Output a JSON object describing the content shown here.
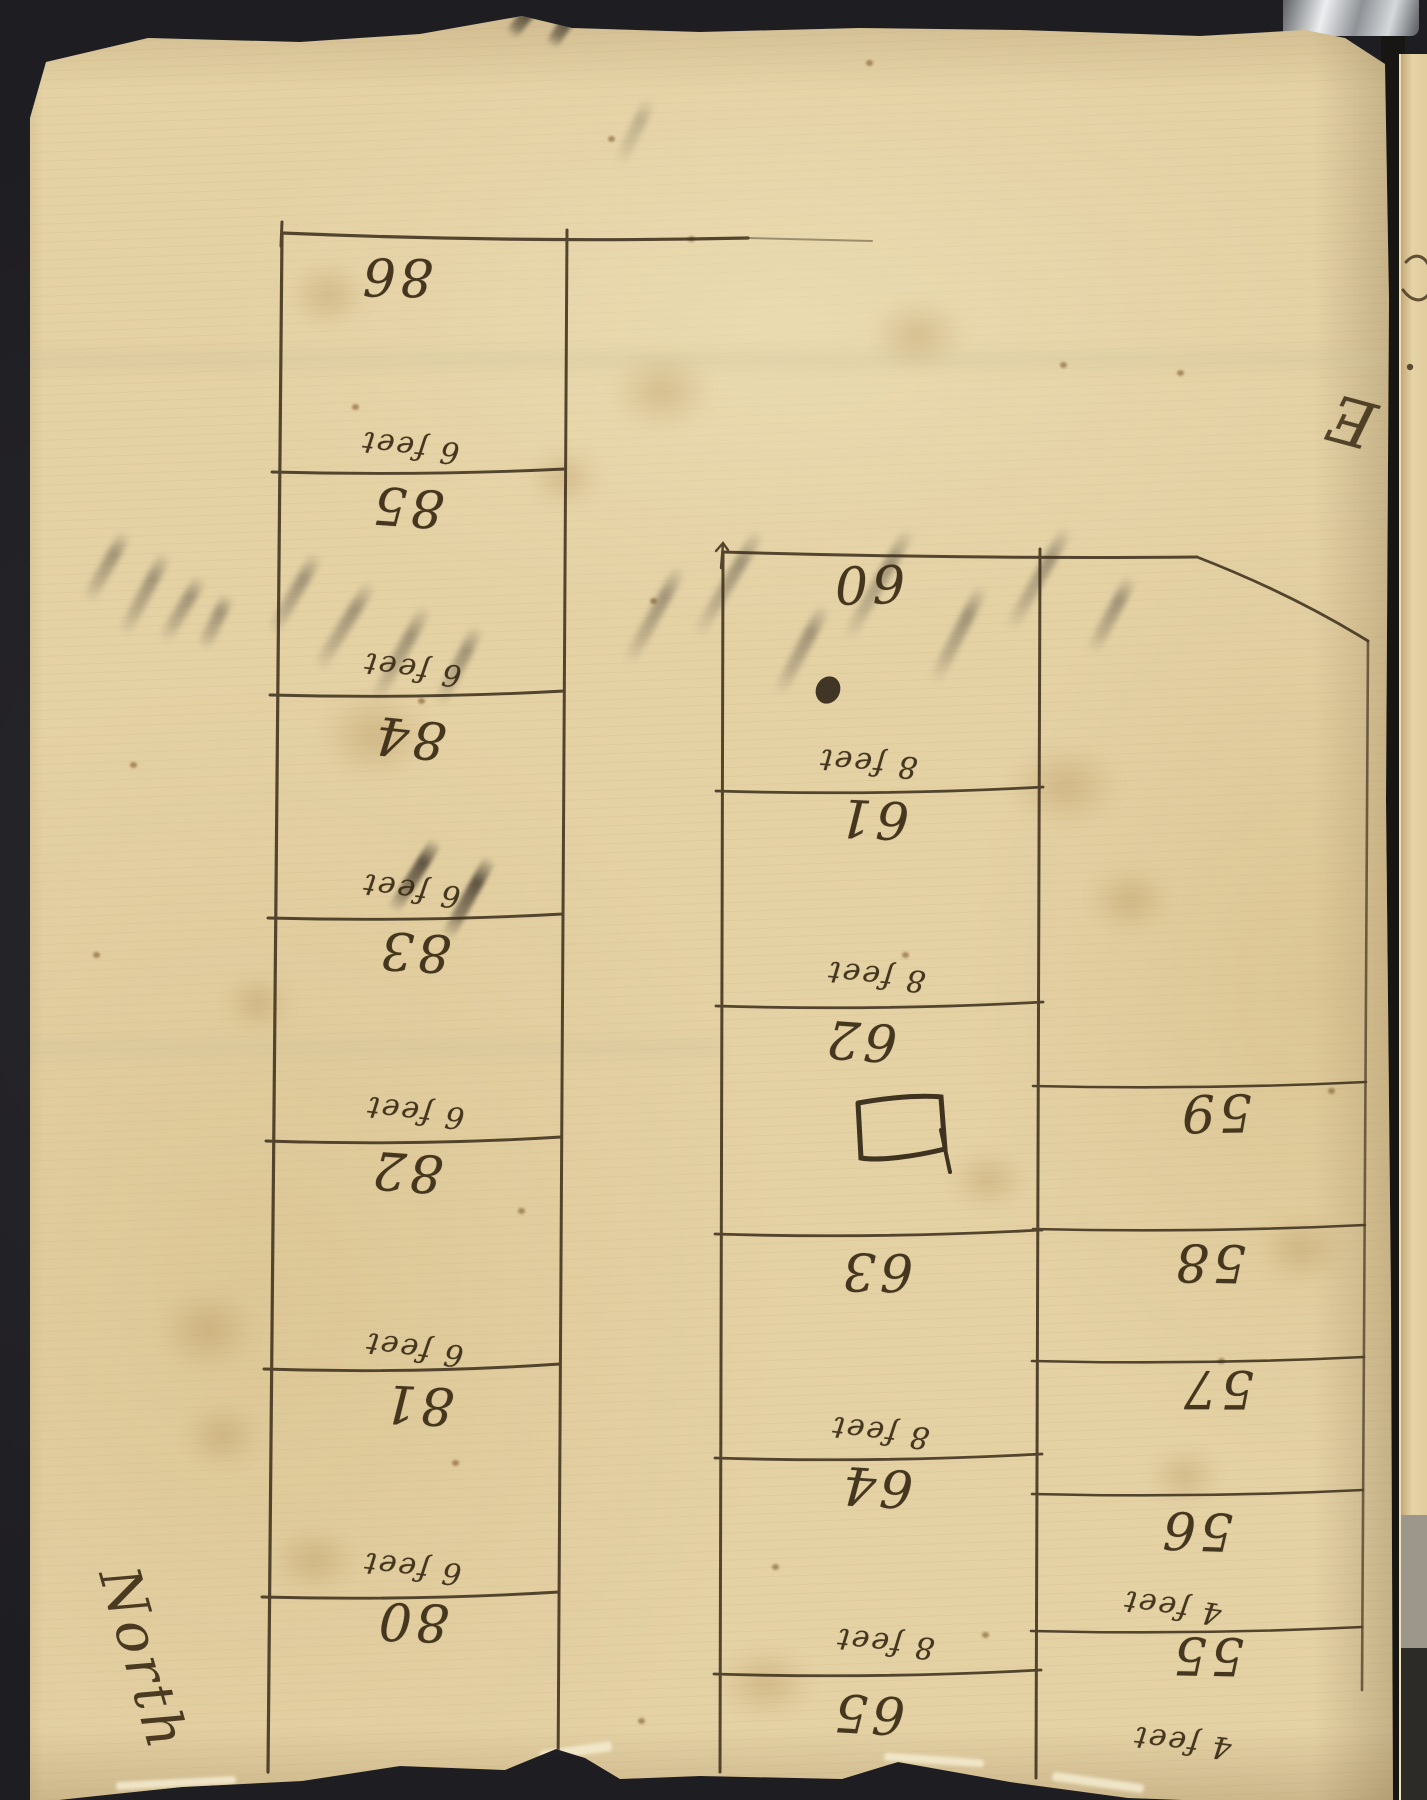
{
  "scene": {
    "description": "Upside-down handwritten survey plot page bound in a volume",
    "background_color": "#232226",
    "paper_color": "#e4d1a4",
    "ink_color": "#3a2b15"
  },
  "lots": {
    "left_block": [
      {
        "number": "86",
        "size_label": "6 feet"
      },
      {
        "number": "85",
        "size_label": "6 feet"
      },
      {
        "number": "84",
        "size_label": "6 feet"
      },
      {
        "number": "83",
        "size_label": "6 feet"
      },
      {
        "number": "82",
        "size_label": "6 feet"
      },
      {
        "number": "81",
        "size_label": "6 feet"
      },
      {
        "number": "80",
        "size_label": ""
      }
    ],
    "middle_block": [
      {
        "number": "60",
        "size_label": "8 feet"
      },
      {
        "number": "61",
        "size_label": "8 feet"
      },
      {
        "number": "62",
        "size_label": ""
      },
      {
        "number": "63",
        "size_label": "8 feet"
      },
      {
        "number": "64",
        "size_label": "8 feet"
      },
      {
        "number": "65",
        "size_label": ""
      }
    ],
    "right_block": [
      {
        "number": "59",
        "size_label": ""
      },
      {
        "number": "58",
        "size_label": ""
      },
      {
        "number": "57",
        "size_label": ""
      },
      {
        "number": "56",
        "size_label": "4 feet"
      },
      {
        "number": "55",
        "size_label": "4 feet"
      }
    ]
  },
  "annotations": {
    "direction_label": "North",
    "page_corner_flourish": "E"
  }
}
